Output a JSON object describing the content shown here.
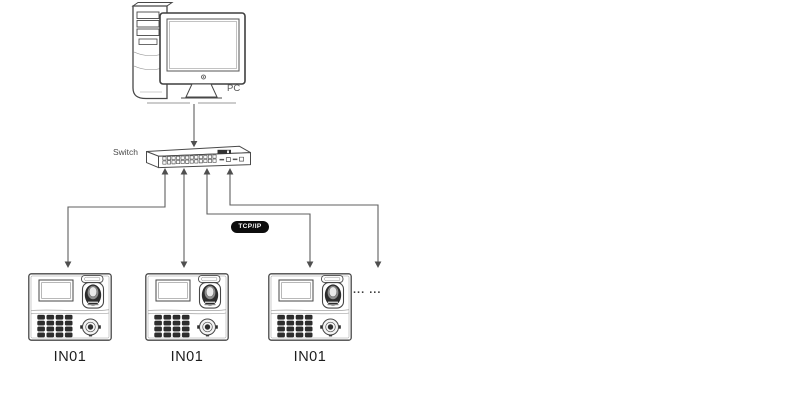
{
  "diagram": {
    "type": "network-topology",
    "pc": {
      "label": "PC"
    },
    "switch": {
      "label": "Switch"
    },
    "protocol_badge": {
      "label": "TCP/IP",
      "bg": "#0d0d0d",
      "fg": "#ffffff"
    },
    "devices": [
      {
        "label": "IN01"
      },
      {
        "label": "IN01"
      },
      {
        "label": "IN01"
      }
    ],
    "more_devices": {
      "label": "... ..."
    },
    "connections": [
      {
        "from": "pc",
        "to": "switch",
        "arrows": "down"
      },
      {
        "from": "switch",
        "to": "device-1",
        "arrows": "both"
      },
      {
        "from": "switch",
        "to": "device-2",
        "arrows": "both"
      },
      {
        "from": "switch",
        "to": "device-3",
        "arrows": "both"
      },
      {
        "from": "switch",
        "to": "more-devices",
        "arrows": "both"
      }
    ],
    "colors": {
      "line": "#5f5f5f",
      "ink": "#474747",
      "label": "#1d1d1d"
    }
  }
}
